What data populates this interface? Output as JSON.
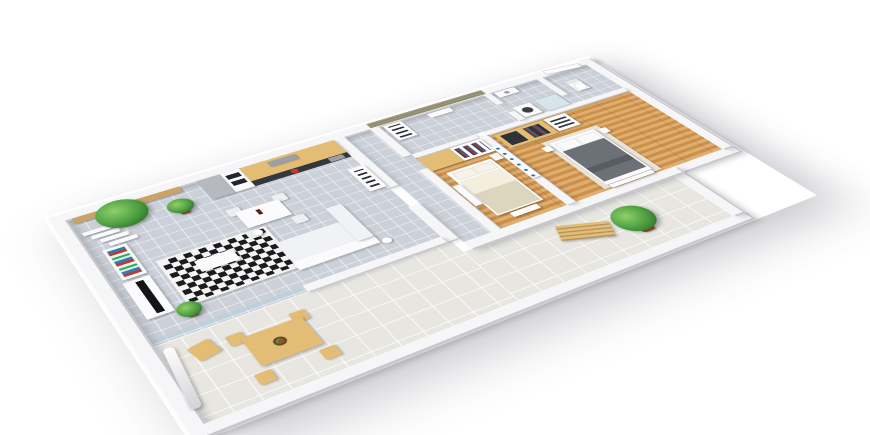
{
  "scene": {
    "kind": "3D isometric floor plan render",
    "subject": "Two-bedroom apartment 3D floor plan with wrap-around tiled terrace",
    "background_color": "#ffffff"
  },
  "palette": {
    "floorGrey": "#ccd1d9",
    "floorTerrace": "#e7e6e1",
    "floorWood": "#d89a4e",
    "wall": "#f6f6f8",
    "wallShade": "#c7c9ce",
    "slatWall": "#8e8a6d",
    "wood": "#e3bc76",
    "counter": "#34383c",
    "appliance": "#b6bac0",
    "white": "#fbfbfd",
    "sofa": "#f0f2f5",
    "rugBlack": "#1c1c1e",
    "rugWhite": "#f4f4f4",
    "bedBeige": "#ddd6bf",
    "bedGrey": "#6b7177",
    "plant": "#4a9c3f",
    "plantDark": "#2e6e27",
    "pot": "#9c5a33",
    "red": "#c23b2e"
  },
  "rooms": [
    {
      "id": "living-dining",
      "name": "Living / Dining Room",
      "floor": "grey ceramic tile",
      "items": [
        "white corner sofa",
        "white coffee table",
        "black-and-white diamond rug",
        "two floor lamps",
        "flat TV on white media panel",
        "white bookshelf with books",
        "folding partition panels",
        "white dining table with four chairs",
        "wine bottle",
        "white sideboard",
        "wall bench with potted palm",
        "potted plant"
      ]
    },
    {
      "id": "kitchen",
      "name": "Kitchen",
      "floor": "grey ceramic tile",
      "items": [
        "light wood cabinets",
        "tall grey cabinet",
        "oven and microwave tower",
        "dark countertop",
        "cooker hood",
        "sink",
        "red cooking pot"
      ]
    },
    {
      "id": "hallway",
      "name": "Hallway",
      "floor": "grey ceramic tile",
      "items": [
        "slatted accent wall",
        "tall storage shelf",
        "radiator shelf"
      ]
    },
    {
      "id": "bathroom",
      "name": "Bathroom / WC",
      "floor": "grey ceramic tile",
      "items": [
        "washing machine",
        "shower",
        "washbasin",
        "toilet"
      ]
    },
    {
      "id": "entry",
      "name": "Entry",
      "floor": "grey ceramic tile",
      "items": [
        "entrance door"
      ]
    },
    {
      "id": "bedroom-1",
      "name": "Bedroom 1",
      "floor": "wood plank",
      "items": [
        "double bed with beige bedding",
        "wardrobe with wood and white doors",
        "clothes on rail",
        "dresser",
        "nightstand",
        "bench"
      ]
    },
    {
      "id": "bedroom-2",
      "name": "Bedroom 2",
      "floor": "wood plank",
      "items": [
        "double bed with grey bedding",
        "open wood wardrobe with clothes",
        "white shelf unit",
        "two nightstands",
        "light area rug",
        "bench"
      ]
    },
    {
      "id": "terrace",
      "name": "Terrace",
      "floor": "light tile",
      "items": [
        "folded parasol",
        "folding chair",
        "wooden dining table with chairs",
        "fruit bowl",
        "wooden sun lounger",
        "potted plant"
      ]
    }
  ],
  "divider": {
    "between": "bedroom-1 and bedroom-2",
    "item": "white shelf wall with blue bottles"
  }
}
